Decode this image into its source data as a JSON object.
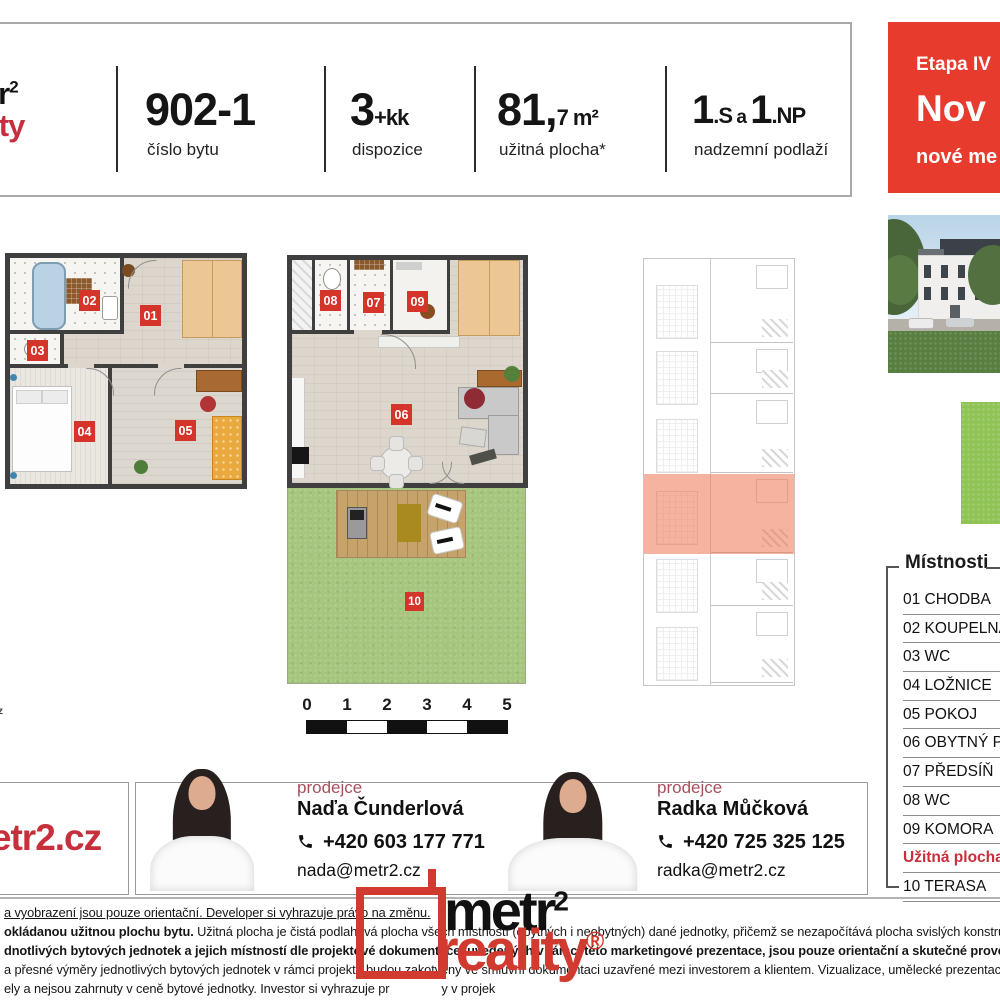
{
  "colors": {
    "brand_red": "#c62f3b",
    "badge_red": "#d5342a",
    "promo_red": "#e73b2e",
    "highlight_salmon": "#ec7452",
    "terrace_green": "#a6c67e",
    "map_green": "#90c356"
  },
  "header": {
    "logo": {
      "black": "metr",
      "sup": "2",
      "red": "reality"
    },
    "unit": {
      "value": "902-1",
      "label": "číslo bytu"
    },
    "disposition": {
      "big": "3",
      "small": "+kk",
      "label": "dispozice"
    },
    "area": {
      "big": "81,",
      "small": "7 m²",
      "label": "užitná plocha*"
    },
    "floors": {
      "big1": "1",
      "small1": ".S",
      "conj": "a",
      "big2": "1",
      "small2": ".NP",
      "label": "nadzemní podlaží"
    }
  },
  "promo": {
    "line1": "Etapa IV",
    "line2": "Nov",
    "line3": "nové me"
  },
  "plans": {
    "lower_badges": [
      "01",
      "02",
      "03",
      "04",
      "05"
    ],
    "upper_badges": [
      "08",
      "07",
      "09",
      "06"
    ],
    "terrace_badge": "10"
  },
  "scalebar": {
    "ticks": [
      "0",
      "1",
      "2",
      "3",
      "4",
      "5"
    ]
  },
  "rooms_list": {
    "title": "Místnosti",
    "items": [
      {
        "text": "01 CHODBA"
      },
      {
        "text": "02 KOUPELNA"
      },
      {
        "text": "03 WC"
      },
      {
        "text": "04 LOŽNICE"
      },
      {
        "text": "05 POKOJ"
      },
      {
        "text": "06 OBYTNÝ PO"
      },
      {
        "text": "07 PŘEDSÍŇ"
      },
      {
        "text": "08 WC"
      },
      {
        "text": "09 KOMORA"
      },
      {
        "text": "Užitná plocha*",
        "accent": true
      },
      {
        "text": "10 TERASA"
      }
    ]
  },
  "website": "metr2.cz",
  "contacts": [
    {
      "role": "prodejce",
      "name": "Naďa Čunderlová",
      "phone": "+420 603 177 771",
      "email": "nada@metr2.cz"
    },
    {
      "role": "prodejce",
      "name": "Radka Můčková",
      "phone": "+420 725 325 125",
      "email": "radka@metr2.cz"
    }
  ],
  "footer_logo": {
    "black": "metr",
    "sup": "2",
    "red": "reality",
    "reg": "®"
  },
  "disclaimer": {
    "lines": [
      {
        "underline": true,
        "text": "a vyobrazení jsou pouze orientační. Developer si vyhrazuje právo na změnu."
      },
      {
        "bold": "okládanou užitnou plochu bytu.",
        "text": " Užitná plocha je čistá podlahová plocha všech místností (obytných i neobytných) dané jednotky, přičemž se nezapočítává plocha svislých konstrukcí uvnitř jednot"
      },
      {
        "bold": "dnotlivých bytových jednotek a jejich místností dle projektové dokumentace, uvedených v rámci této marketingové prezentace, jsou pouze orientační a skutečné provedení může být v rámci"
      },
      {
        "text": "a přesné výměry jednotlivých bytových jednotek v rámci projektu budou zakotveny ve smluvní dokumentaci uzavřené mezi investorem a klientem. Vizualizace, umělecké prezentace a dekorace in"
      },
      {
        "text": "ely a nejsou zahrnuty v ceně bytové jednotky. Investor si vyhrazuje pr",
        "text2": "y v projek"
      }
    ]
  },
  "misc": {
    "edge_fragment": "z"
  }
}
